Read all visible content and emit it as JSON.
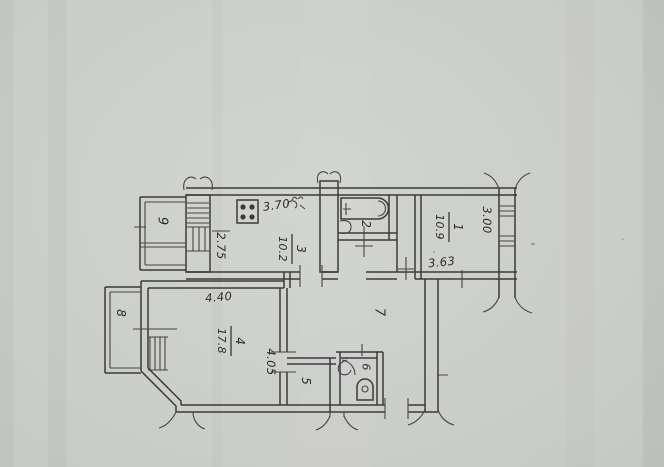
{
  "document": {
    "kind": "scanned apartment floor plan"
  },
  "palette": {
    "paper": "#cbcdc9",
    "ink": "#3a3a3a"
  },
  "rooms": {
    "r1": {
      "number": "1",
      "area": "10.9",
      "width": "3.63",
      "depth": "3.00"
    },
    "r2": {
      "number": "2"
    },
    "r3": {
      "number": "3",
      "area": "10.2",
      "width": "3.70",
      "depth": "2.75"
    },
    "r4": {
      "number": "4",
      "area": "17.8",
      "width": "4.40",
      "depth": "4.05"
    },
    "r5": {
      "number": "5"
    },
    "r6": {
      "number": "6"
    },
    "r7": {
      "number": "7"
    },
    "r8": {
      "number": "8"
    },
    "r9": {
      "number": "9"
    }
  },
  "icons": {
    "stove": "stove-icon",
    "kitchen_sink": "kitchen-sink-icon",
    "bathtub": "bathtub-icon",
    "washbasin": "washbasin-icon",
    "toilet": "toilet-icon",
    "wc_sink": "wc-sink-icon"
  }
}
